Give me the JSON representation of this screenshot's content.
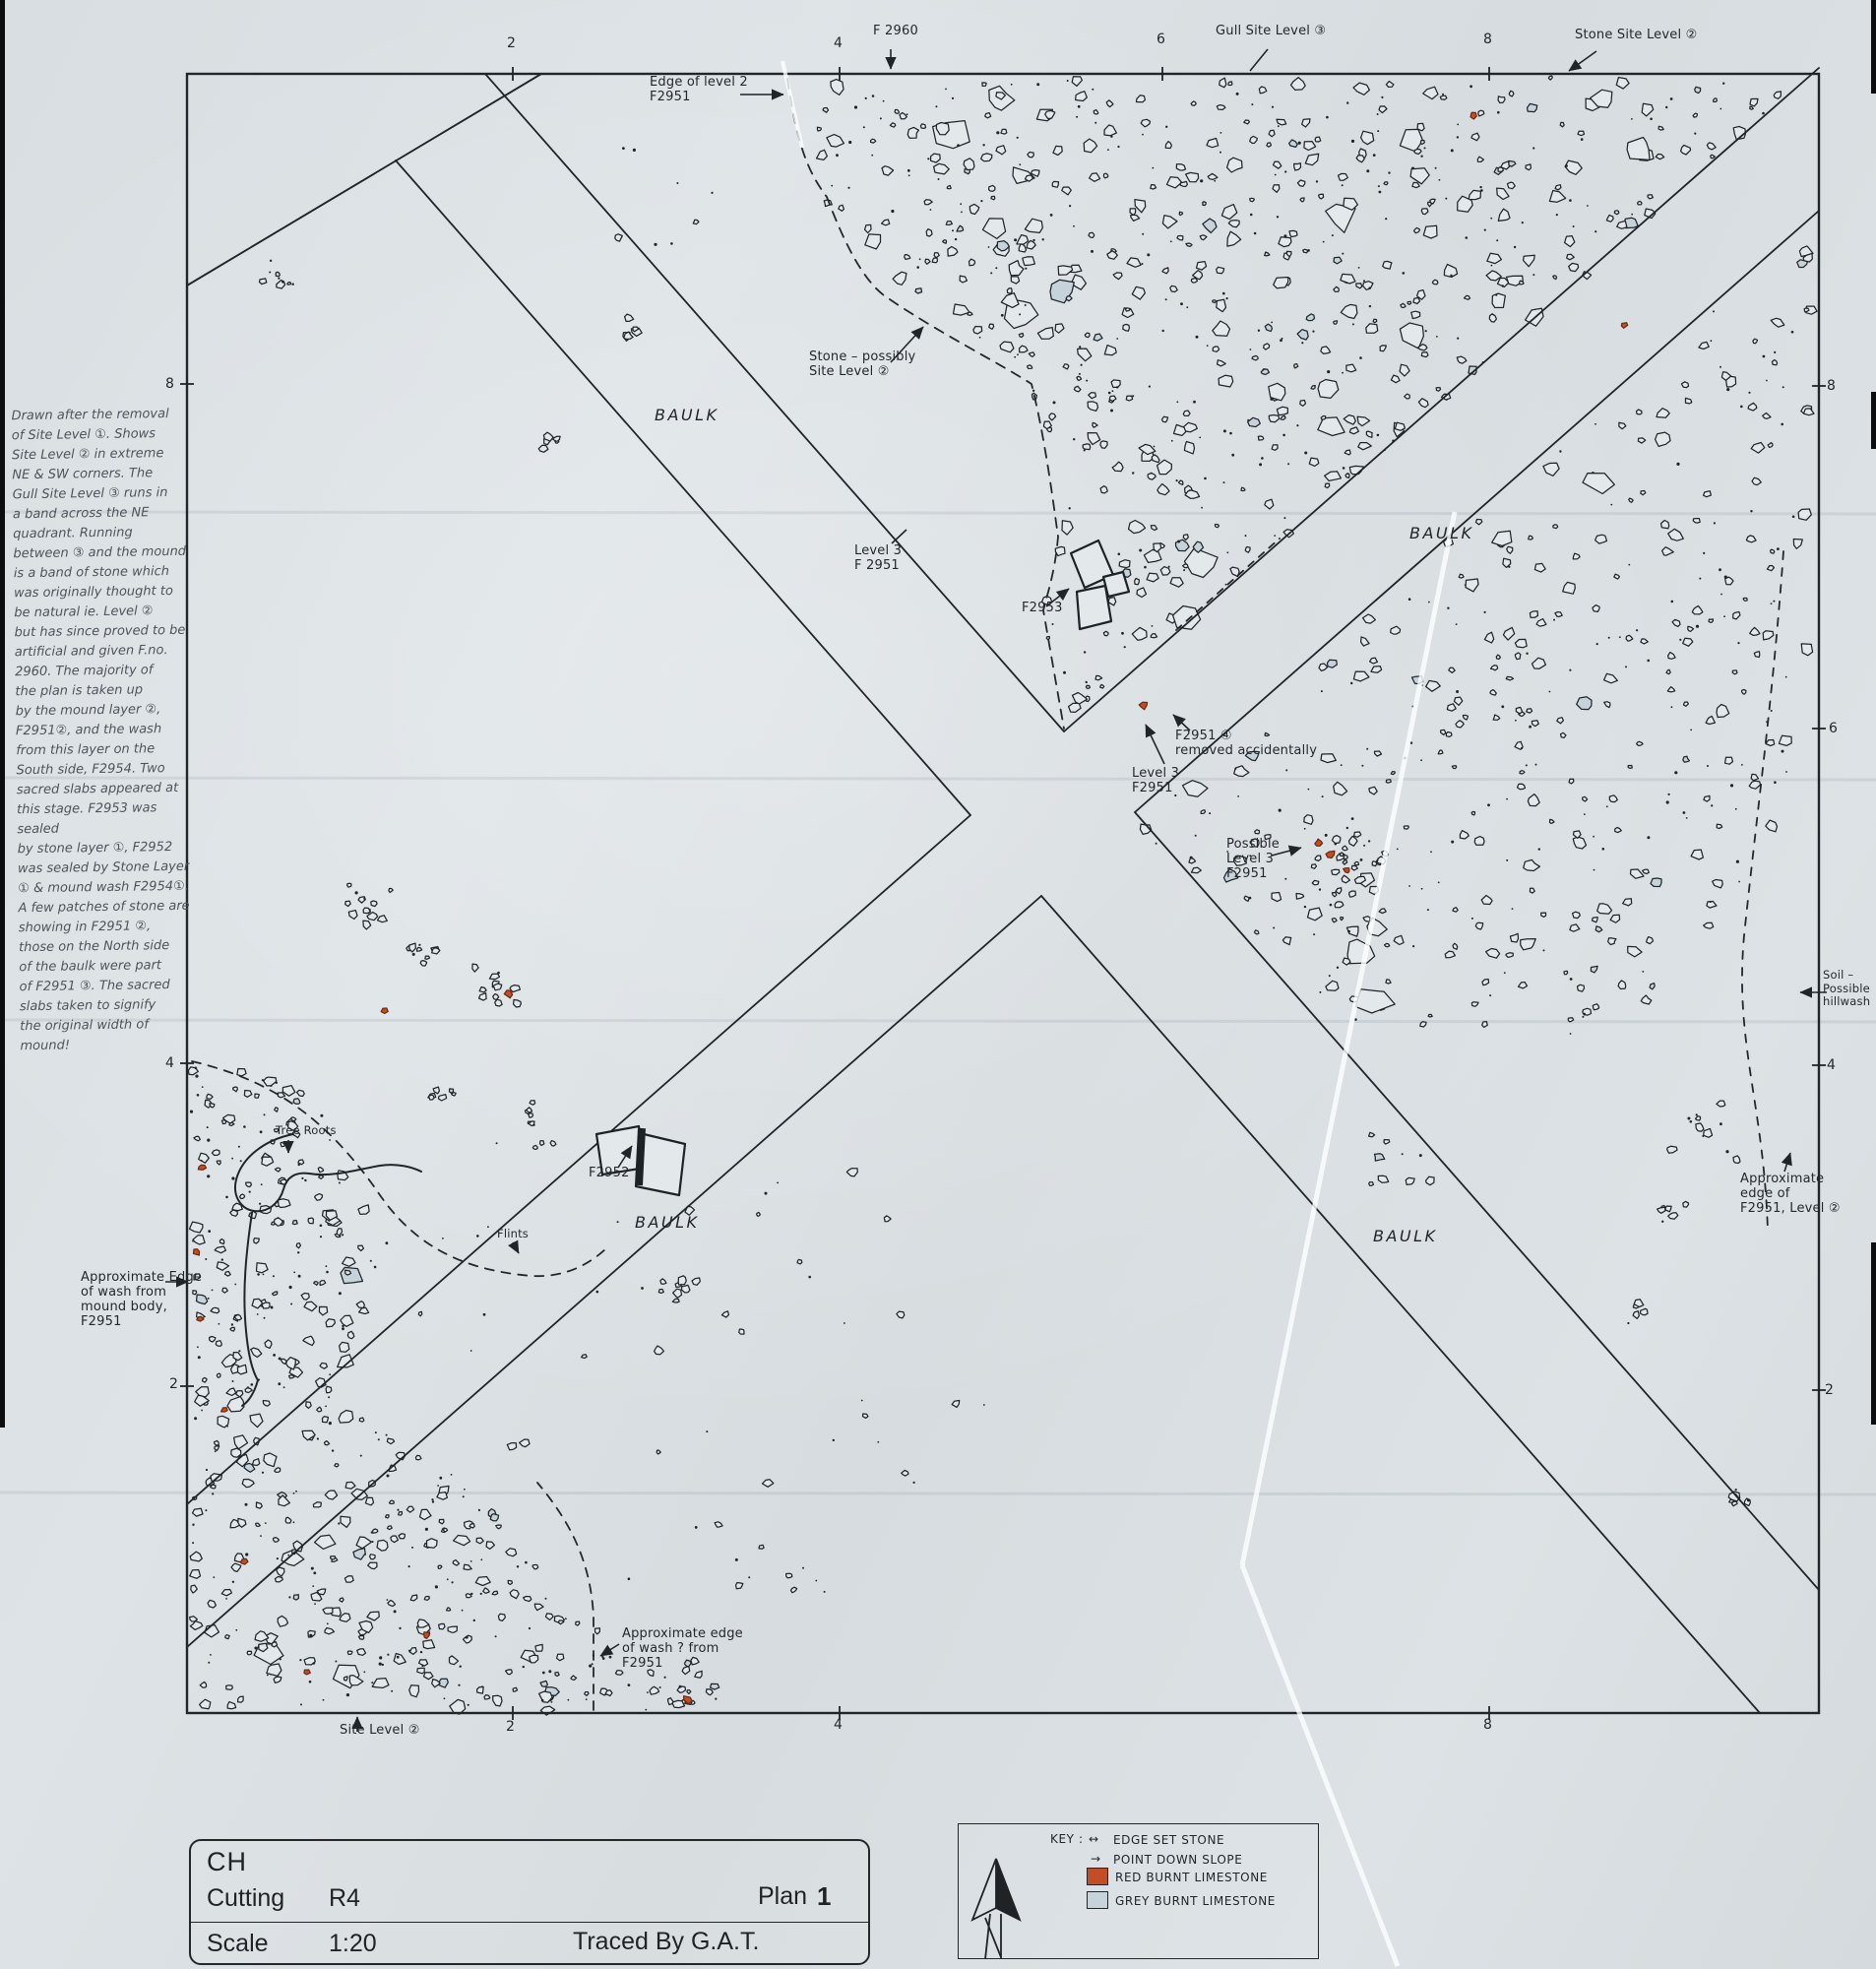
{
  "margin_note": {
    "text": "Drawn after the removal\nof Site Level ①. Shows\nSite Level ② in extreme\nNE & SW corners. The\nGull Site Level ③ runs in\na band across the NE\nquadrant. Running\nbetween ③ and the mound\nis a band of stone which\nwas originally thought to\nbe natural ie. Level ②\nbut has since proved to be\nartificial and given F.no.\n2960. The majority of\nthe plan is taken up\nby the mound layer ②,\nF2951②, and the wash\nfrom this layer on the\nSouth side, F2954. Two\nsacred slabs appeared at\nthis stage. F2953 was sealed\nby stone layer ①, F2952\nwas sealed by Stone Layer\n① & mound wash F2954①.\nA few patches of stone are\nshowing in F2951 ②,\nthose on the North side\nof the baulk were part\nof F2951 ③. The sacred\nslabs taken to signify\nthe original width of\nmound!"
  },
  "labels": {
    "f2960": "F 2960",
    "gull_site_level": "Gull Site Level ③",
    "stone_site_level": "Stone Site Level ②",
    "edge_of_level_2": "Edge of level 2\nF2951",
    "stone_possibly": "Stone – possibly\nSite Level ②",
    "level3_f2951_nw": "Level 3\nF 2951",
    "f2953": "F2953",
    "f2951_removed": "F2951 ④\nremoved accidentally",
    "level3_f2951_s": "Level 3\nF2951",
    "possible_level3": "Possible\nLevel 3\nF2951",
    "soil_hillwash": "Soil –\nPossible\nhillwash",
    "approx_edge_f2951_level2": "Approximate\nedge of\nF2951, Level ②",
    "tree_roots": "Tree Roots",
    "f2952": "F2952",
    "flints": "Flints",
    "approx_edge_wash_left": "Approximate Edge\nof wash from\nmound body,\nF2951",
    "approx_edge_wash_bottom": "Approximate edge\nof wash ? from\nF2951",
    "site_level_2": "Site Level ②",
    "baulk": "BAULK"
  },
  "grid": {
    "top": [
      "2",
      "4",
      "6",
      "8"
    ],
    "bottom": [
      "2",
      "4",
      "8"
    ],
    "left": [
      "8",
      "4",
      "2"
    ],
    "right": [
      "8",
      "6",
      "4",
      "2"
    ]
  },
  "title_block": {
    "site": "CH",
    "cutting_label": "Cutting",
    "cutting_value": "R4",
    "plan_label": "Plan",
    "plan_value": "1",
    "scale_label": "Scale",
    "scale_value": "1:20",
    "traced": "Traced By G.A.T."
  },
  "key": {
    "title": "KEY :",
    "items": [
      {
        "symbol": "double-arrow",
        "label": "EDGE SET STONE"
      },
      {
        "symbol": "arrow",
        "label": "POINT DOWN SLOPE"
      },
      {
        "symbol": "red-square",
        "label": "RED BURNT LIMESTONE"
      },
      {
        "symbol": "grey-square",
        "label": "GREY BURNT LIMESTONE"
      }
    ]
  },
  "colors": {
    "ink": "#20252a",
    "pencil": "#4d545b",
    "paper": "#dadfe2",
    "stone_fill": "#e3e9ea",
    "red_limestone": "#c24e26",
    "grey_limestone": "#c6d3da"
  }
}
